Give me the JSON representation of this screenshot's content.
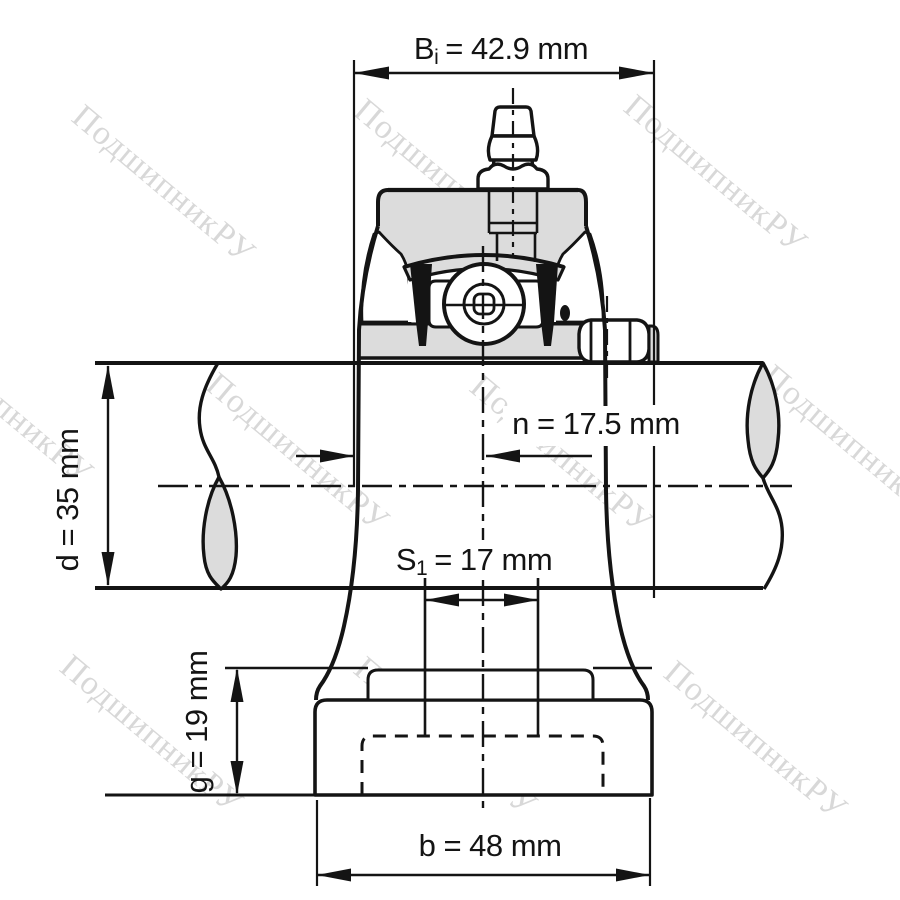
{
  "title": "Pillow block bearing unit — dimensional technical drawing",
  "watermark": {
    "text": "ПодшипникРУ",
    "color": "#d8d8d8"
  },
  "colors": {
    "line": "#141414",
    "metal_fill": "#dcdcdc",
    "seal_fill": "#141414",
    "background": "#ffffff"
  },
  "dimensions": {
    "Bi": {
      "symbol": "B",
      "subscript": "i",
      "value": "= 42.9 mm",
      "mm": 42.9
    },
    "n": {
      "label": "n = 17.5 mm",
      "mm": 17.5
    },
    "d": {
      "label": "d = 35 mm",
      "mm": 35
    },
    "S1": {
      "symbol": "S",
      "subscript": "1",
      "value": "= 17 mm",
      "mm": 17
    },
    "g": {
      "label": "g = 19 mm",
      "mm": 19
    },
    "b": {
      "label": "b = 48 mm",
      "mm": 48
    }
  }
}
